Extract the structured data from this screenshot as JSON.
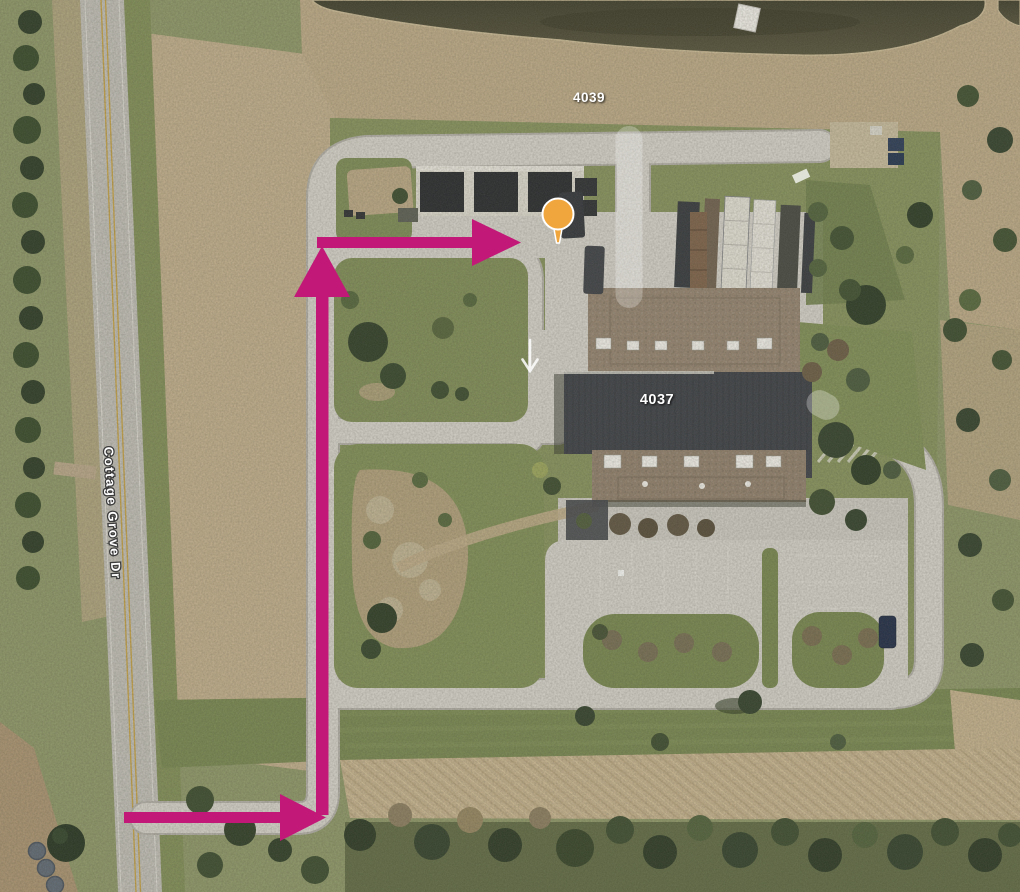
{
  "map": {
    "street": {
      "label": "Cottage Grove Dr"
    },
    "buildings": {
      "north_label": "4039",
      "main_label": "4037"
    },
    "route": {
      "color": "#c21878",
      "style": "arrow-path",
      "segments": [
        {
          "name": "entrance-from-street",
          "direction": "east"
        },
        {
          "name": "driveway-north",
          "direction": "north"
        },
        {
          "name": "driveway-to-destination",
          "direction": "east"
        }
      ]
    },
    "destination_pin": {
      "color": "#f0a63c",
      "outline": "#ffffff"
    },
    "pavement_marking": {
      "type": "one-way-arrow",
      "direction": "south",
      "color": "#ffffff"
    }
  }
}
